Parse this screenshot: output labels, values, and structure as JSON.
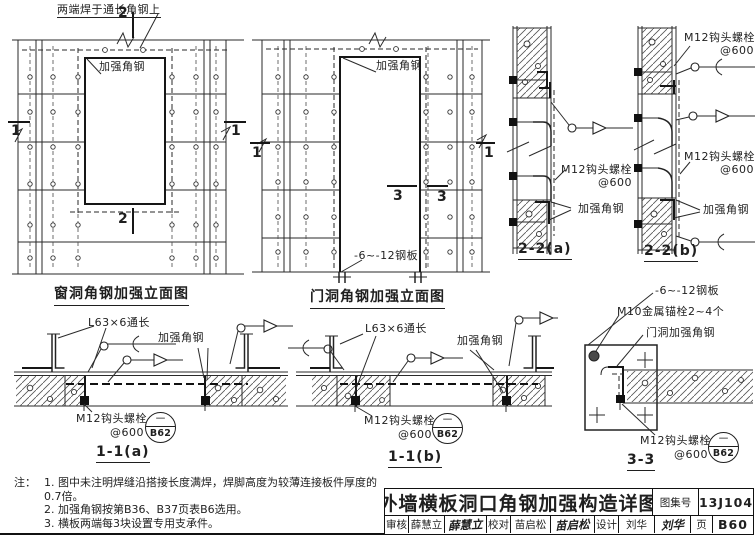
{
  "window_elevation": {
    "title": "窗洞角钢加强立面图",
    "top_callout": "两端焊于通长角钢上",
    "angle_label": "加强角钢",
    "mark_2": "2",
    "mark_1": "1"
  },
  "door_elevation": {
    "title": "门洞角钢加强立面图",
    "angle_label": "加强角钢",
    "plate_label": "-6~-12钢板",
    "mark_3": "3",
    "mark_1": "1"
  },
  "section_22a": {
    "title": "2-2(a)",
    "bolt_label": "M12钩头螺栓",
    "bolt_spacing": "@600",
    "angle_label": "加强角钢"
  },
  "section_22b": {
    "title": "2-2(b)",
    "bolt_label_top": "M12钩头螺栓",
    "bolt_spacing_top": "@600",
    "bolt_label_mid": "M12钩头螺栓",
    "bolt_spacing_mid": "@600",
    "angle_label": "加强角钢"
  },
  "section_11a": {
    "title": "1-1(a)",
    "angle_length_label": "L63×6通长",
    "angle_label": "加强角钢",
    "bolt_label": "M12钩头螺栓",
    "bolt_spacing": "@600",
    "ref_num": "一",
    "ref_page": "B62"
  },
  "section_11b": {
    "title": "1-1(b)",
    "angle_length_label": "L63×6通长",
    "angle_label": "加强角钢",
    "bolt_label": "M12钩头螺栓",
    "bolt_spacing": "@600",
    "ref_num": "一",
    "ref_page": "B62"
  },
  "section_33": {
    "title": "3-3",
    "plate_label": "-6~-12钢板",
    "anchor_label": "M10金属锚栓2~4个",
    "door_angle_label": "门洞加强角钢",
    "bolt_label": "M12钩头螺栓",
    "bolt_spacing": "@600",
    "ref_num": "一",
    "ref_page": "B62"
  },
  "notes": {
    "prefix": "注：",
    "items": [
      "1. 图中未注明焊缝沿搭接长度满焊，焊脚高度为较薄连接板件厚度的0.7倍。",
      "2. 加强角钢按第B36、B37页表B6选用。",
      "3. 横板两端每3块设置专用支承件。"
    ]
  },
  "title_block": {
    "drawing_title": "外墙横板洞口角钢加强构造详图",
    "atlas_label": "图集号",
    "atlas_number": "13J104",
    "page_label": "页",
    "page_number": "B60",
    "reviewer_label": "审核",
    "reviewer_name": "薛慧立",
    "reviewer_signature": "薛慧立",
    "checker_label": "校对",
    "checker_name": "苗启松",
    "checker_signature": "苗启松",
    "designer_label": "设计",
    "designer_name": "刘华",
    "designer_signature": "刘华"
  }
}
